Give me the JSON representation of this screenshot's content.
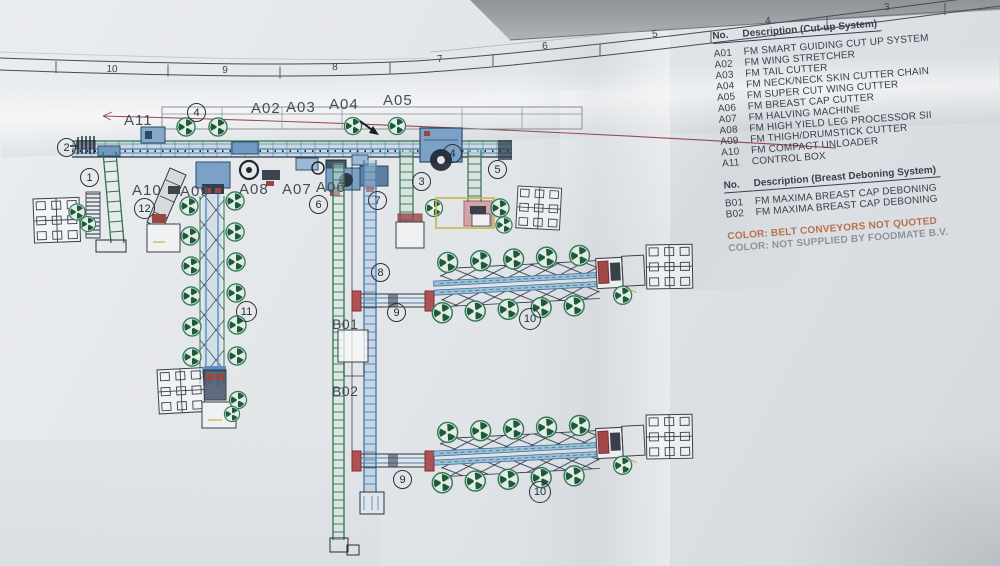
{
  "ruler": {
    "numbers": [
      "10",
      "9",
      "8",
      "7",
      "6",
      "5",
      "4",
      "3"
    ]
  },
  "legend_cutup": {
    "no_header": "No.",
    "desc_header": "Description (Cut-up System)",
    "items": [
      {
        "no": "A01",
        "desc": "FM SMART GUIDING CUT UP SYSTEM"
      },
      {
        "no": "A02",
        "desc": "FM WING STRETCHER"
      },
      {
        "no": "A03",
        "desc": "FM TAIL CUTTER"
      },
      {
        "no": "A04",
        "desc": "FM NECK/NECK SKIN CUTTER CHAIN"
      },
      {
        "no": "A05",
        "desc": "FM SUPER CUT WING CUTTER"
      },
      {
        "no": "A06",
        "desc": "FM BREAST CAP CUTTER"
      },
      {
        "no": "A07",
        "desc": "FM HALVING MACHINE"
      },
      {
        "no": "A08",
        "desc": "FM HIGH YIELD LEG PROCESSOR SII"
      },
      {
        "no": "A09",
        "desc": "FM THIGH/DRUMSTICK CUTTER"
      },
      {
        "no": "A10",
        "desc": "FM COMPACT UNLOADER"
      },
      {
        "no": "A11",
        "desc": "CONTROL BOX"
      }
    ]
  },
  "legend_deboning": {
    "no_header": "No.",
    "desc_header": "Description (Breast Deboning System)",
    "items": [
      {
        "no": "B01",
        "desc": "FM MAXIMA BREAST CAP DEBONING"
      },
      {
        "no": "B02",
        "desc": "FM MAXIMA BREAST CAP DEBONING"
      }
    ]
  },
  "notes": {
    "belt": "COLOR: BELT CONVEYORS NOT QUOTED",
    "supply": "COLOR: NOT SUPPLIED BY FOODMATE B.V."
  },
  "drawing_labels": {
    "a11": "A11",
    "a02": "A02",
    "a03": "A03",
    "a04": "A04",
    "a05": "A05",
    "a10": "A10",
    "a09": "A09",
    "a08": "A08",
    "a07": "A07",
    "a06": "A06",
    "b01": "B01",
    "b02": "B02"
  },
  "callouts": [
    {
      "n": "2"
    },
    {
      "n": "1"
    },
    {
      "n": "12"
    },
    {
      "n": "4"
    },
    {
      "n": "6"
    },
    {
      "n": "7"
    },
    {
      "n": "3"
    },
    {
      "n": "4"
    },
    {
      "n": "5"
    },
    {
      "n": "8"
    },
    {
      "n": "9"
    },
    {
      "n": "11"
    },
    {
      "n": "10"
    },
    {
      "n": "9"
    },
    {
      "n": "10"
    }
  ],
  "colors": {
    "conveyor_blue": "#4d7dab",
    "machine_green": "#2f7350",
    "accent_red": "#9c4545",
    "accent_yellow": "#c9b44a",
    "note_orange": "#b5714a",
    "note_gray": "#8e939b"
  }
}
